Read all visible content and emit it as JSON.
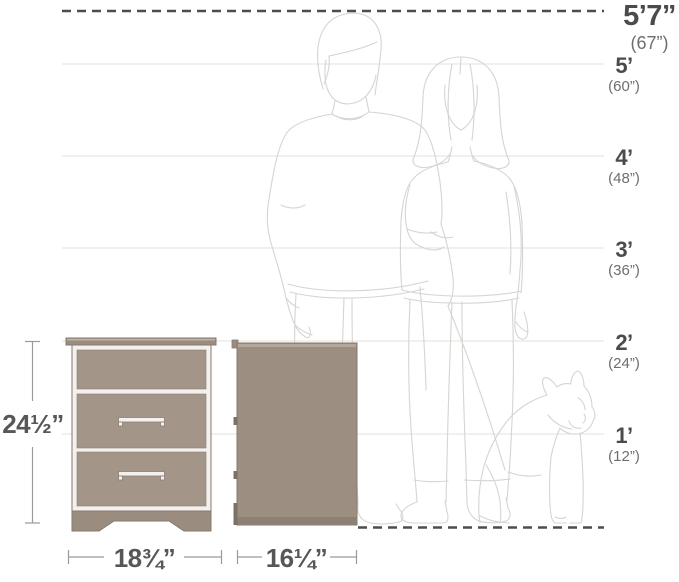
{
  "diagram": {
    "type": "product-dimension-diagram",
    "subject": "two-drawer-nightstand-with-human-and-dog-scale"
  },
  "scale": {
    "labels": [
      {
        "feet": "5’7”",
        "inches": "(67”)"
      },
      {
        "feet": "5’",
        "inches": "(60”)"
      },
      {
        "feet": "4’",
        "inches": "(48”)"
      },
      {
        "feet": "3’",
        "inches": "(36”)"
      },
      {
        "feet": "2’",
        "inches": "(24”)"
      },
      {
        "feet": "1’",
        "inches": "(12”)"
      }
    ]
  },
  "dimensions": {
    "height": "24½”",
    "width": "18¾”",
    "depth": "16¼”"
  },
  "figures": {
    "man": "man-silhouette",
    "woman": "woman-silhouette",
    "dog": "dog-silhouette"
  },
  "colors": {
    "furniture_fill": "#a39688",
    "furniture_dark": "#9a8d80",
    "furniture_outline": "#877a6e",
    "panel_gap": "#f3f0ed",
    "dashed_line": "#4d4d4d",
    "grid_line": "#e3e1df",
    "figure_line": "#d7d4d1",
    "label_dark": "#4b4b4b",
    "label_gray": "#6e6e6e",
    "dimension_text": "#575757"
  }
}
